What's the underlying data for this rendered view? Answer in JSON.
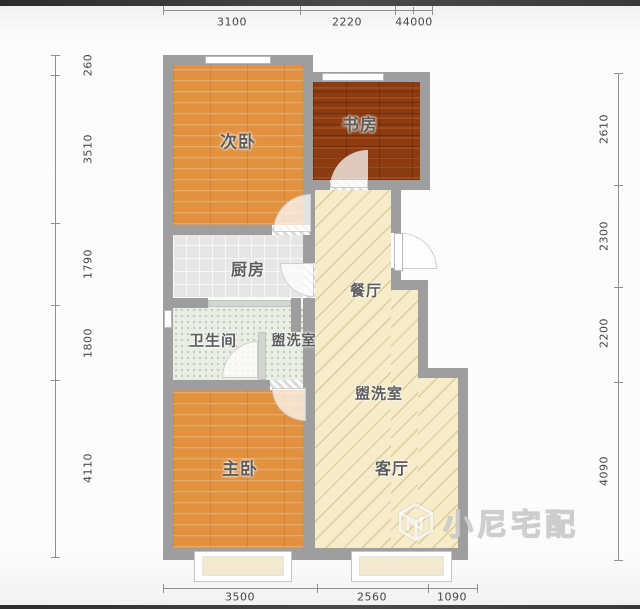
{
  "page": {
    "type": "apartment-floor-plan"
  },
  "rooms": {
    "secondary_bedroom": "次卧",
    "study": "书房",
    "kitchen": "厨房",
    "dining": "餐厅",
    "bathroom": "卫生间",
    "washroom_1": "盥洗室",
    "washroom_2": "盥洗室",
    "master_bedroom": "主卧",
    "living": "客厅"
  },
  "dims": {
    "top": [
      "3100",
      "2220",
      "44000"
    ],
    "left": [
      "260",
      "3510",
      "1790",
      "1800",
      "4110"
    ],
    "right": [
      "2610",
      "2300",
      "2200",
      "4090"
    ],
    "bottom": [
      "3500",
      "2560",
      "1090"
    ]
  },
  "watermark": {
    "brand": "小尼宅配"
  },
  "colors": {
    "wall": "#9e9e9e",
    "wood_light": "#e2913f",
    "wood_dark": "#8d3b10",
    "tile": "#e4e7e4",
    "speckle": "#e9eee4",
    "beige": "#f6ecca",
    "dim_text": "#454545"
  }
}
